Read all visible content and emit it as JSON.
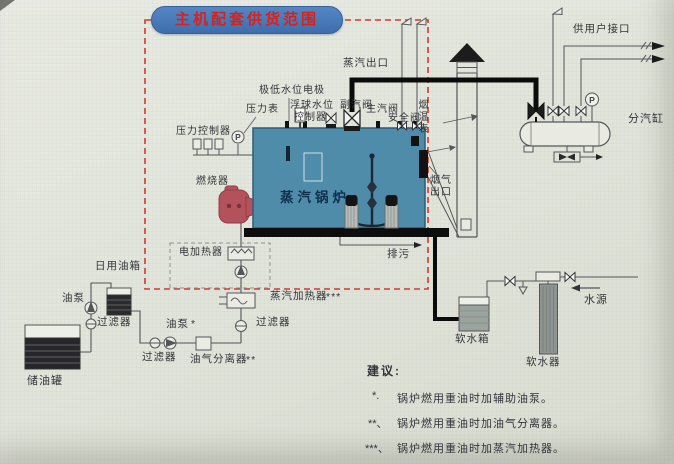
{
  "title": "主机配套供货范围",
  "boiler": {
    "name": "蒸汽锅炉"
  },
  "labels": {
    "steam_outlet": "蒸汽出口",
    "low_water_electrode": "极低水位电极",
    "pressure_gauge": "压力表",
    "float_level_1": "浮球水位",
    "float_level_2": "控制器",
    "aux_steam_valve": "副汽阀",
    "main_steam_valve": "主汽阀",
    "safety_valve": "安全阀",
    "flue_temp_gauge": "烟温表",
    "flue_outlet_1": "烟气",
    "flue_outlet_2": "出口",
    "pressure_controller": "压力控制器",
    "burner": "燃烧器",
    "electric_heater": "电加热器",
    "blowdown": "排污",
    "steam_heater": "蒸汽加热器",
    "steam_heater_mark": "***",
    "oil_pump": "油泵",
    "oil_pump_mark": "*",
    "filter": "过滤器",
    "oil_gas_separator": "油气分离器",
    "oil_gas_separator_mark": "**",
    "daily_oil_tank": "日用油箱",
    "oil_storage_tank": "储油罐",
    "user_interface": "供用户接口",
    "steam_cylinder": "分汽缸",
    "water_source": "水源",
    "soft_water_tank": "软水箱",
    "water_softener": "软水器",
    "gauge_symbol": "P"
  },
  "notes": {
    "heading": "建议:",
    "items": [
      {
        "marker": "*.",
        "text": "锅炉燃用重油时加辅助油泵。"
      },
      {
        "marker": "**、",
        "text": "锅炉燃用重油时加油气分离器。"
      },
      {
        "marker": "***、",
        "text": "锅炉燃用重油时加蒸汽加热器。"
      }
    ]
  },
  "colors": {
    "boiler_fill": "#4e8caa",
    "burner_fill": "#b4525c",
    "boundary_red": "#cf3a2e",
    "badge_blue": "#4a7cba",
    "badge_text_red": "#d5231b",
    "pipe_black": "#0b0b0b"
  }
}
